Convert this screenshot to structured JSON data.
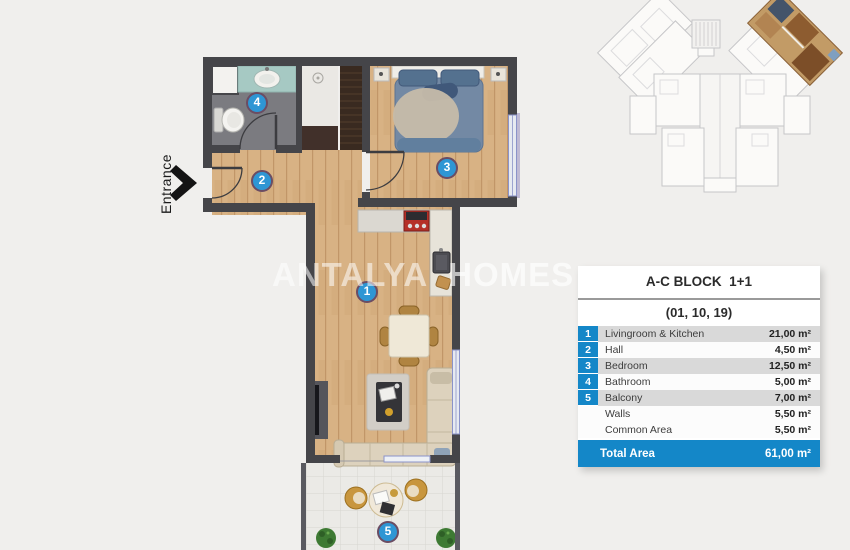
{
  "colors": {
    "accent": "#1487c8",
    "row_shade": "#d9d9d9",
    "badge_blue": "#2e96d4",
    "wall_gray": "#454549",
    "wood_floor": "#d8b284",
    "highlight_unit": "#c29b66"
  },
  "watermark": {
    "part1": "ANTALYA",
    "part2": "HOMES"
  },
  "floor_plan": {
    "entrance_label": "Entrance",
    "rooms": [
      {
        "number": "1"
      },
      {
        "number": "2"
      },
      {
        "number": "3"
      },
      {
        "number": "4"
      },
      {
        "number": "5"
      }
    ]
  },
  "area_table": {
    "title": "A-C BLOCK  1+1",
    "subtitle": "(01, 10, 19)",
    "rows": [
      {
        "num": "1",
        "label": "Livingroom & Kitchen",
        "value": "21,00 m²"
      },
      {
        "num": "2",
        "label": "Hall",
        "value": "4,50 m²"
      },
      {
        "num": "3",
        "label": "Bedroom",
        "value": "12,50 m²"
      },
      {
        "num": "4",
        "label": "Bathroom",
        "value": "5,00 m²"
      },
      {
        "num": "5",
        "label": "Balcony",
        "value": "7,00 m²"
      },
      {
        "num": "",
        "label": "Walls",
        "value": "5,50 m²"
      },
      {
        "num": "",
        "label": "Common Area",
        "value": "5,50 m²"
      }
    ],
    "total": {
      "label": "Total Area",
      "value": "61,00 m²"
    }
  }
}
